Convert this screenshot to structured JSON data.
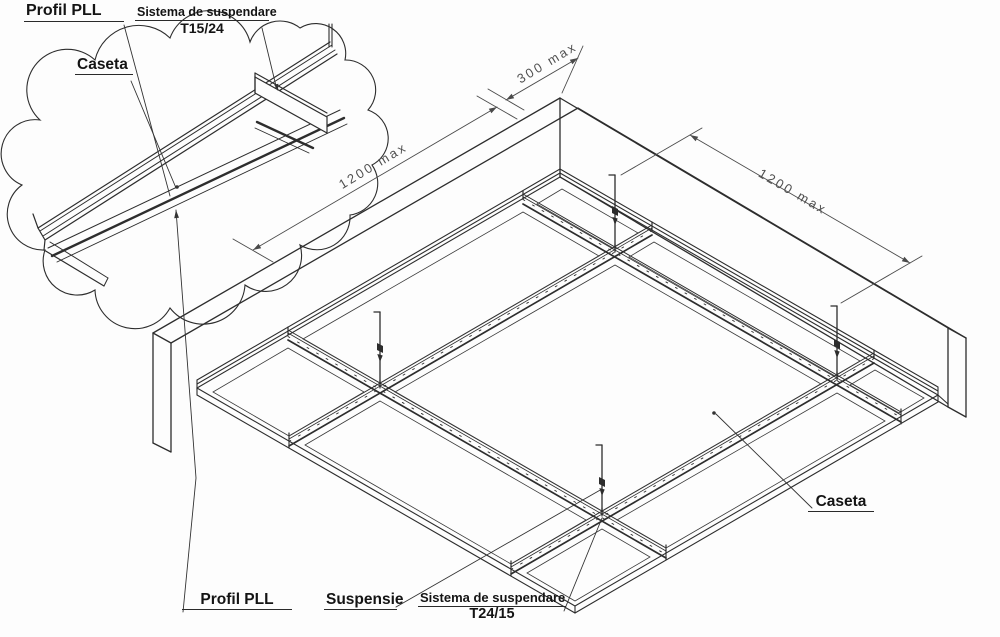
{
  "drawing": {
    "background": "#fdfdfd",
    "line_color": "#2d2d2d",
    "dim_color": "#4a4a4a",
    "type": "suspended ceiling grid - isometric technical drawing"
  },
  "callout": {
    "profil_pll": "Profil PLL",
    "sistema_line1": "Sistema de suspendare",
    "sistema_line2": "T15/24",
    "caseta": "Caseta"
  },
  "main": {
    "caseta": "Caseta",
    "profil_pll": "Profil PLL",
    "suspensie": "Suspensie",
    "sistema_line1": "Sistema de suspendare",
    "sistema_line2": "T24/15",
    "dim_left": "1200 max",
    "dim_top": "300 max",
    "dim_right": "1200 max"
  }
}
